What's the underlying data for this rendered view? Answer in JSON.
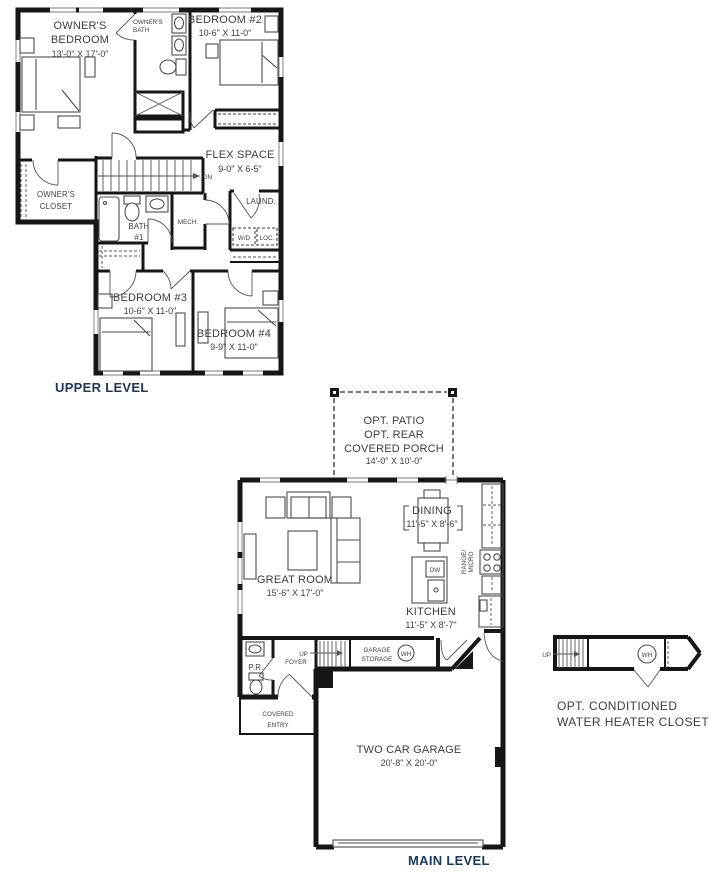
{
  "colors": {
    "wall": "#161616",
    "text": "#3e3e3e",
    "level_label": "#1c3a5e",
    "background": "#ffffff"
  },
  "upper": {
    "title": "UPPER LEVEL",
    "owners_bedroom": {
      "line1": "OWNER'S",
      "line2": "BEDROOM",
      "dims": "13'-0\" X 17'-0\""
    },
    "owners_bath": {
      "line1": "OWNER'S",
      "line2": "BATH"
    },
    "bedroom2": {
      "name": "BEDROOM #2",
      "dims": "10-6\" X 11-0\""
    },
    "flex": {
      "name": "FLEX SPACE",
      "dims": "9-0\" X 6-5\""
    },
    "stairs": {
      "dn": "DN"
    },
    "owners_closet": {
      "line1": "OWNER'S",
      "line2": "CLOSET"
    },
    "bath1": {
      "line1": "BATH",
      "line2": "#1"
    },
    "mech": {
      "name": "MECH."
    },
    "laundry": {
      "name": "LAUND.",
      "wd": "W/D",
      "loc": "LOC."
    },
    "bedroom3": {
      "name": "BEDROOM #3",
      "dims": "10-6\" X 11-0\""
    },
    "bedroom4": {
      "name": "BEDROOM #4",
      "dims": "9-9\" X 11-0\""
    }
  },
  "main": {
    "title": "MAIN LEVEL",
    "porch": {
      "line1": "OPT. PATIO",
      "line2": "OPT. REAR",
      "line3": "COVERED PORCH",
      "dims": "14'-0\" X 10'-0\""
    },
    "great_room": {
      "name": "GREAT ROOM",
      "dims": "15'-6\" X 17'-0\""
    },
    "dining": {
      "name": "DINING",
      "dims": "11'-5\" X 8'-6\""
    },
    "kitchen": {
      "name": "KITCHEN",
      "dims": "11'-5\" X 8'-7\"",
      "dw": "DW",
      "range1": "RANGE/",
      "range2": "MICRO"
    },
    "pr": "P.R.",
    "foyer": "FOYER",
    "stairs": {
      "up": "UP"
    },
    "storage": {
      "line1": "GARAGE",
      "line2": "STORAGE"
    },
    "water_heater": "WH",
    "covered_entry": {
      "line1": "COVERED",
      "line2": "ENTRY"
    },
    "garage": {
      "name": "TWO CAR GARAGE",
      "dims": "20'-8\" X 20'-0\""
    }
  },
  "detail": {
    "up": "UP",
    "wh": "WH",
    "line1": "OPT. CONDITIONED",
    "line2": "WATER HEATER CLOSET"
  }
}
